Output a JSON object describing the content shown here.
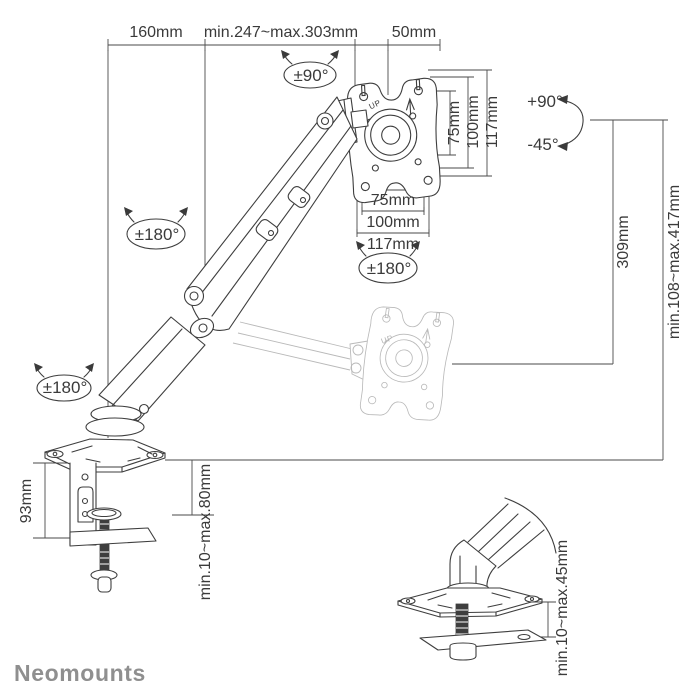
{
  "brand": {
    "logo": "Neomounts"
  },
  "colors": {
    "line": "#3e3e3e",
    "ghost": "#b9b9b9",
    "logo": "#8f8f8f",
    "background": "#ffffff"
  },
  "diagram": {
    "top_dimensions": {
      "base_offset": "160mm",
      "horizontal_reach": "min.247~max.303mm",
      "head_depth": "50mm"
    },
    "vesa_plate": {
      "up_label": "UP",
      "vertical": {
        "inner": "75mm",
        "middle": "100mm",
        "outer": "117mm"
      },
      "horizontal": {
        "inner": "75mm",
        "middle": "100mm",
        "outer": "117mm"
      }
    },
    "ghost_plate": {
      "up_label": "UP"
    },
    "rotations": {
      "head_swivel": "±90°",
      "elbow_swivel": "±180°",
      "plate_rotation": "±180°",
      "base_swivel": "±180°",
      "tilt_up": "+90°",
      "tilt_down": "-45°"
    },
    "heights": {
      "pivot_height": "309mm",
      "height_range": "min.108~max.417mm"
    },
    "clamp": {
      "bracket_height": "93mm",
      "desk_thickness_range": "min.10~max.80mm"
    },
    "grommet": {
      "desk_thickness_range": "min.10~max.45mm"
    }
  }
}
